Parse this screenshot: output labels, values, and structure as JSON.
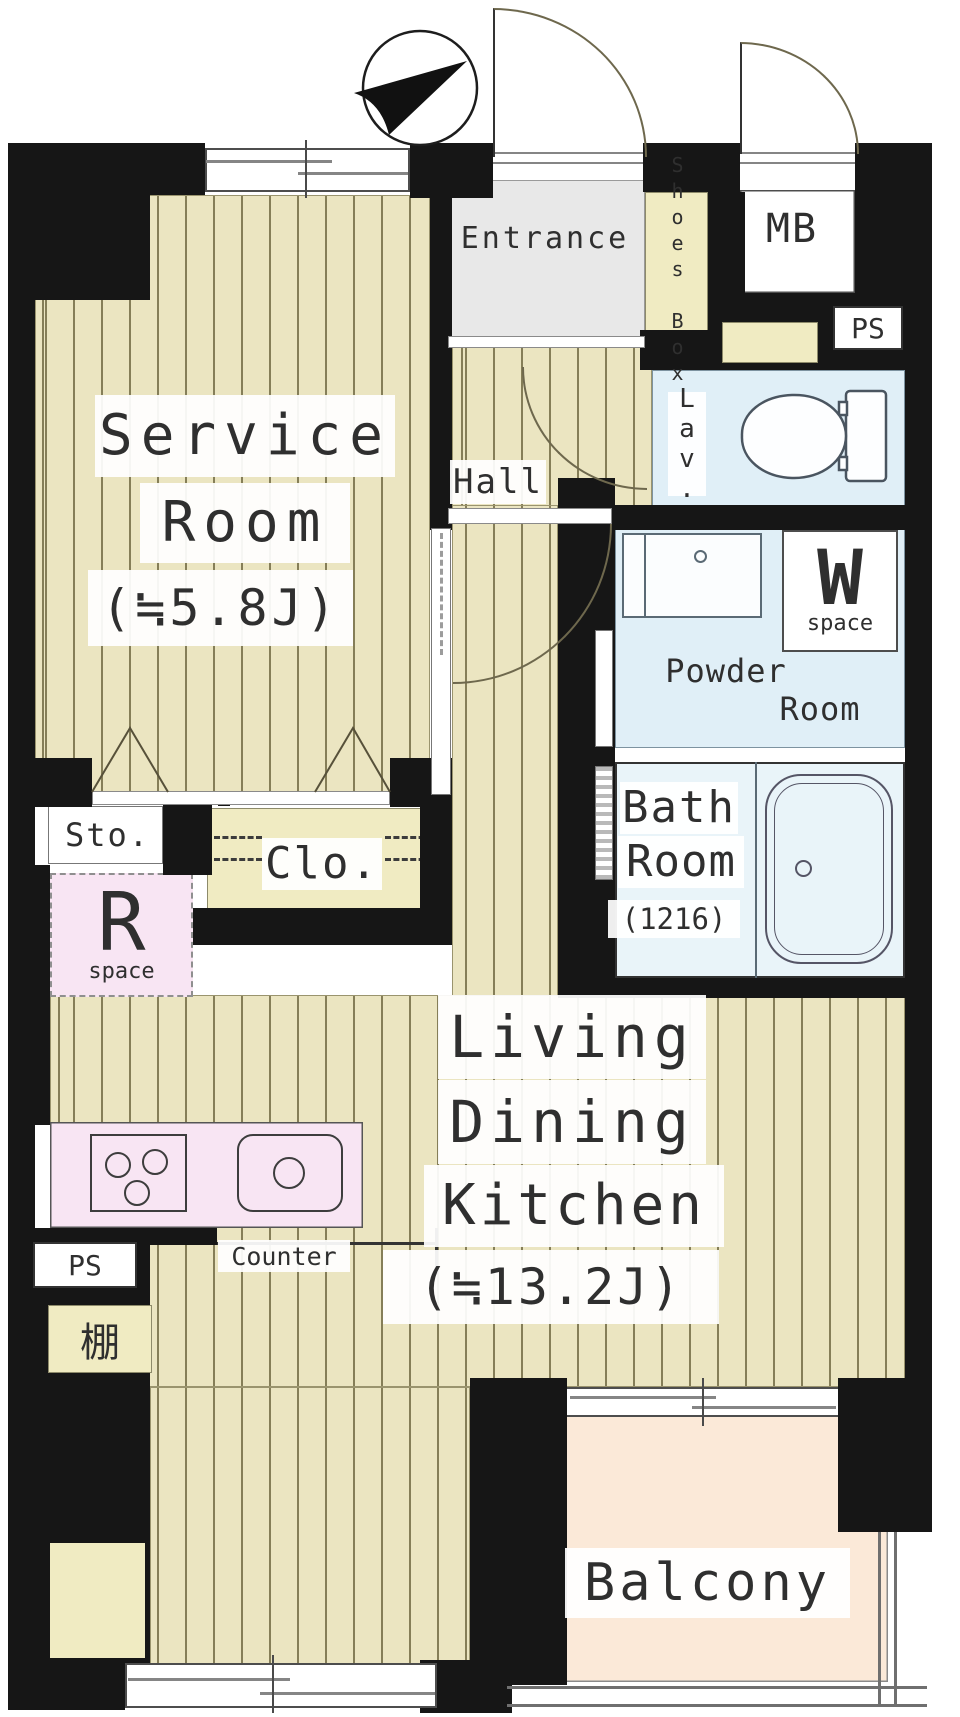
{
  "plan_title": "apartment-floor-plan",
  "colors": {
    "wall": "#161616",
    "floor": "#ebe5c1",
    "stripe": "#857e58",
    "wet": "#e0eff7",
    "entrance": "#e8e8e8",
    "cream": "#f0ebc2",
    "pink": "#f8e5f3",
    "balcony": "#fbe9d8",
    "line": "#555555",
    "text": "#2f2f2f",
    "arc": "#6e684d"
  },
  "rooms": {
    "service_room": {
      "line1": "Service",
      "line2": "Room",
      "area": "(≒5.8J)"
    },
    "entrance": {
      "label": "Entrance"
    },
    "shoes_box": {
      "label": "Shoes Box"
    },
    "meter_box": {
      "label": "MB"
    },
    "pipe_space_top": {
      "label": "PS"
    },
    "lavatory": {
      "label": "Lav."
    },
    "powder_room": {
      "line1": "Powder",
      "line2": "Room"
    },
    "washer_space": {
      "letter": "W",
      "sub": "space"
    },
    "bath_room": {
      "line1": "Bath",
      "line2": "Room",
      "size": "(1216)"
    },
    "hall": {
      "label": "Hall"
    },
    "storage": {
      "label": "Sto."
    },
    "closet": {
      "label": "Clo."
    },
    "refrigerator_space": {
      "letter": "R",
      "sub": "space"
    },
    "ldk": {
      "line1": "Living",
      "line2": "Dining",
      "line3": "Kitchen",
      "area": "(≒13.2J)"
    },
    "counter": {
      "label": "Counter"
    },
    "pipe_space_left": {
      "label": "PS"
    },
    "shelf": {
      "label": "棚"
    },
    "balcony": {
      "label": "Balcony"
    }
  }
}
